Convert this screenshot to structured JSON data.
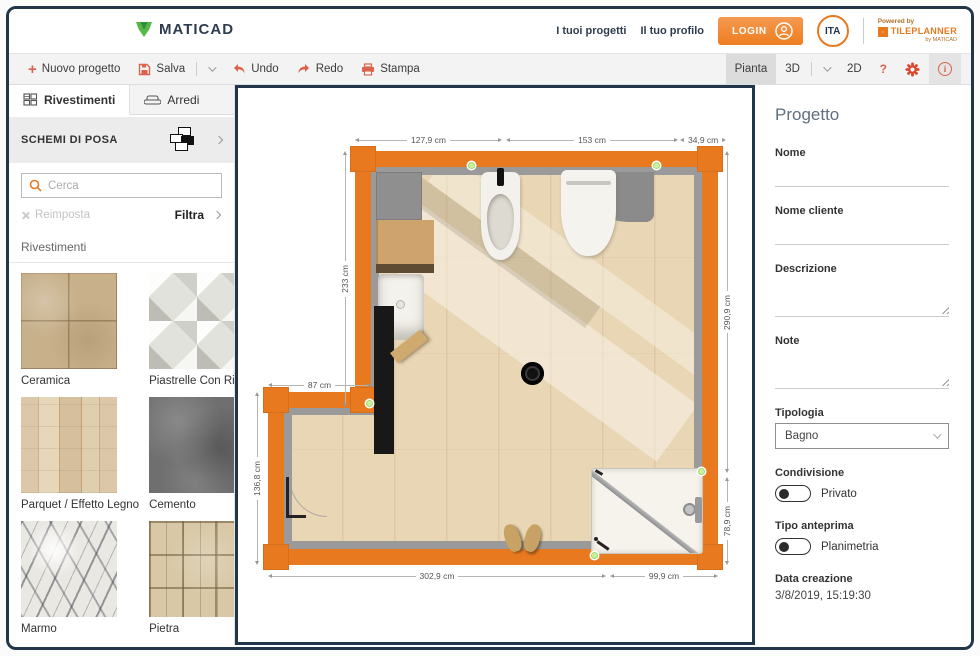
{
  "header": {
    "logo_text": "MATICAD",
    "nav_projects": "I tuoi progetti",
    "nav_profile": "Il tuo profilo",
    "login_label": "LOGIN",
    "language": "ITA",
    "powered_by": "Powered by",
    "powered_brand": "TILEPLANNER",
    "powered_sub": "by MATICAD"
  },
  "toolbar": {
    "new_project": "Nuovo progetto",
    "save": "Salva",
    "undo": "Undo",
    "redo": "Redo",
    "print": "Stampa",
    "view_plan": "Pianta",
    "view_3d": "3D",
    "view_2d": "2D",
    "help": "?"
  },
  "sidebar": {
    "tab_coverings": "Rivestimenti",
    "tab_furniture": "Arredi",
    "laying_schemes": "SCHEMI DI POSA",
    "search_placeholder": "Cerca",
    "reset": "Reimposta",
    "filter": "Filtra",
    "section_title": "Rivestimenti",
    "categories": [
      "Ceramica",
      "Piastrelle Con Rilievo",
      "Parquet / Effetto Legno",
      "Cemento",
      "Marmo",
      "Pietra"
    ]
  },
  "plan": {
    "dims": {
      "top_1": "127,9 cm",
      "top_2": "153 cm",
      "top_3": "34,9 cm",
      "left_upper": "233 cm",
      "step": "87 cm",
      "left_lower": "136,8 cm",
      "bottom_1": "302,9 cm",
      "bottom_2": "99,9 cm",
      "right_upper": "290,9 cm",
      "right_lower": "78,9 cm"
    }
  },
  "panel": {
    "title": "Progetto",
    "name_label": "Nome",
    "client_label": "Nome cliente",
    "description_label": "Descrizione",
    "notes_label": "Note",
    "type_label": "Tipologia",
    "type_value": "Bagno",
    "sharing_label": "Condivisione",
    "sharing_value": "Privato",
    "preview_label": "Tipo anteprima",
    "preview_value": "Planimetria",
    "created_label": "Data creazione",
    "created_value": "3/8/2019, 15:19:30"
  },
  "colors": {
    "accent_orange": "#e8791f",
    "navy": "#22364a",
    "toolbar_icon": "#d9634b",
    "logo_green": "#46a546",
    "snap_dot_green": "#cdf2a2"
  }
}
